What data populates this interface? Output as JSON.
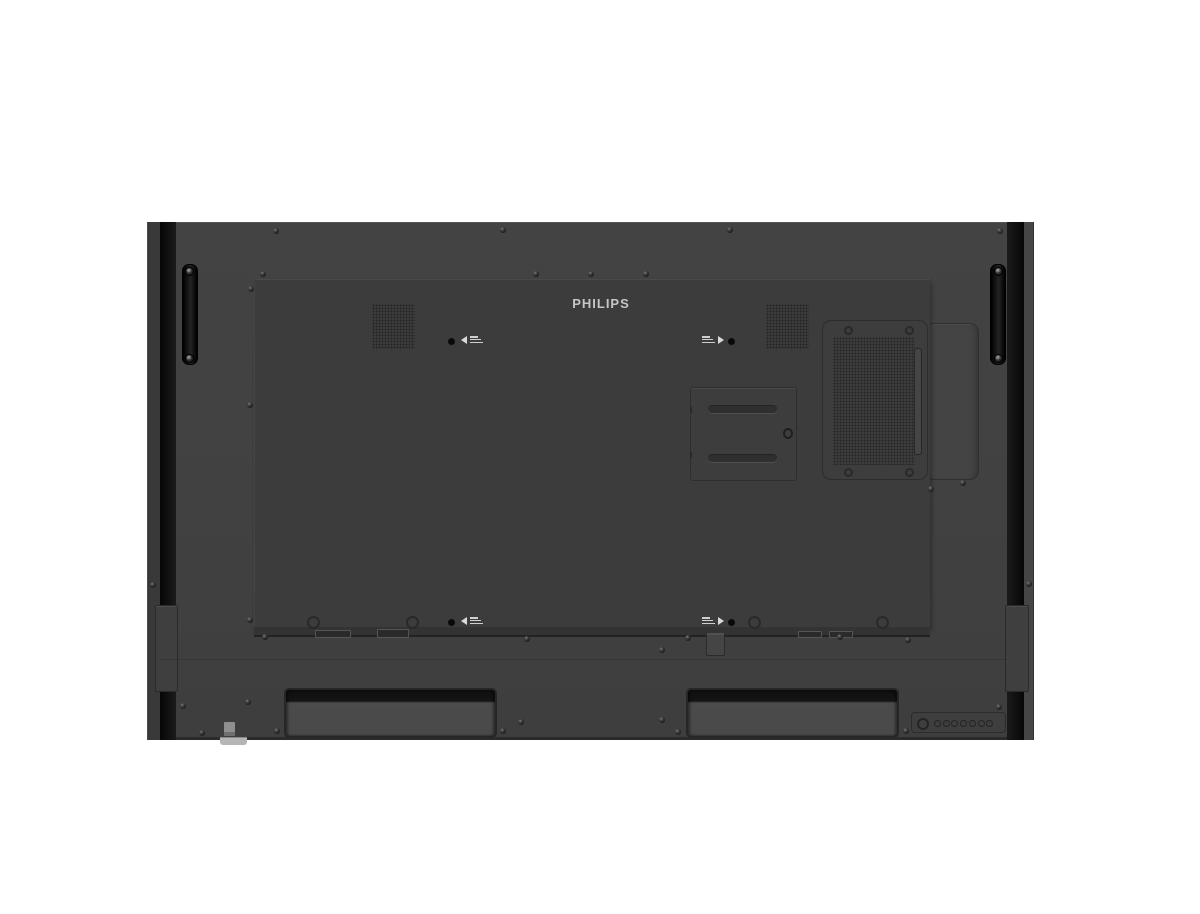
{
  "brand": {
    "label": "PHILIPS"
  },
  "device": {
    "description": "rear view of a Philips large-format display",
    "colors": {
      "background": "#ffffff",
      "outer_panel": "#414141",
      "inner_panel": "#3c3c3c",
      "black_trim": "#0f0f0f",
      "logo_text": "#c6c6c6",
      "module_cover": "#444444",
      "recess_face": "#4b4b4b"
    }
  },
  "hardware": {
    "screws": [
      [
        276,
        231
      ],
      [
        503,
        230
      ],
      [
        730,
        230
      ],
      [
        1000,
        231
      ],
      [
        263,
        274
      ],
      [
        536,
        274
      ],
      [
        591,
        274
      ],
      [
        646,
        274
      ],
      [
        251,
        289
      ],
      [
        250,
        405
      ],
      [
        250,
        620
      ],
      [
        153,
        585
      ],
      [
        1029,
        584
      ],
      [
        265,
        637
      ],
      [
        527,
        639
      ],
      [
        688,
        638
      ],
      [
        840,
        637
      ],
      [
        908,
        640
      ],
      [
        662,
        650
      ],
      [
        183,
        706
      ],
      [
        248,
        702
      ],
      [
        662,
        720
      ],
      [
        521,
        722
      ],
      [
        202,
        733
      ],
      [
        277,
        731
      ],
      [
        503,
        731
      ],
      [
        678,
        732
      ],
      [
        906,
        731
      ],
      [
        999,
        707
      ],
      [
        931,
        489
      ],
      [
        963,
        483
      ]
    ],
    "ring_holes": [
      [
        313,
        622
      ],
      [
        412,
        622
      ],
      [
        754,
        622
      ],
      [
        882,
        622
      ]
    ],
    "vent_corner_screws": [
      [
        848,
        330
      ],
      [
        909,
        330
      ],
      [
        848,
        472
      ],
      [
        909,
        472
      ]
    ],
    "handle_screws": [
      [
        188,
        270
      ],
      [
        188,
        357
      ],
      [
        997,
        270
      ],
      [
        997,
        357
      ]
    ],
    "control_panel": {
      "small_button_count": 7,
      "has_power_ring": true
    },
    "speaker_labels": [
      {
        "position": "top-left",
        "arrow": "left"
      },
      {
        "position": "top-right",
        "arrow": "right"
      },
      {
        "position": "bottom-left",
        "arrow": "left"
      },
      {
        "position": "bottom-right",
        "arrow": "right"
      }
    ]
  }
}
